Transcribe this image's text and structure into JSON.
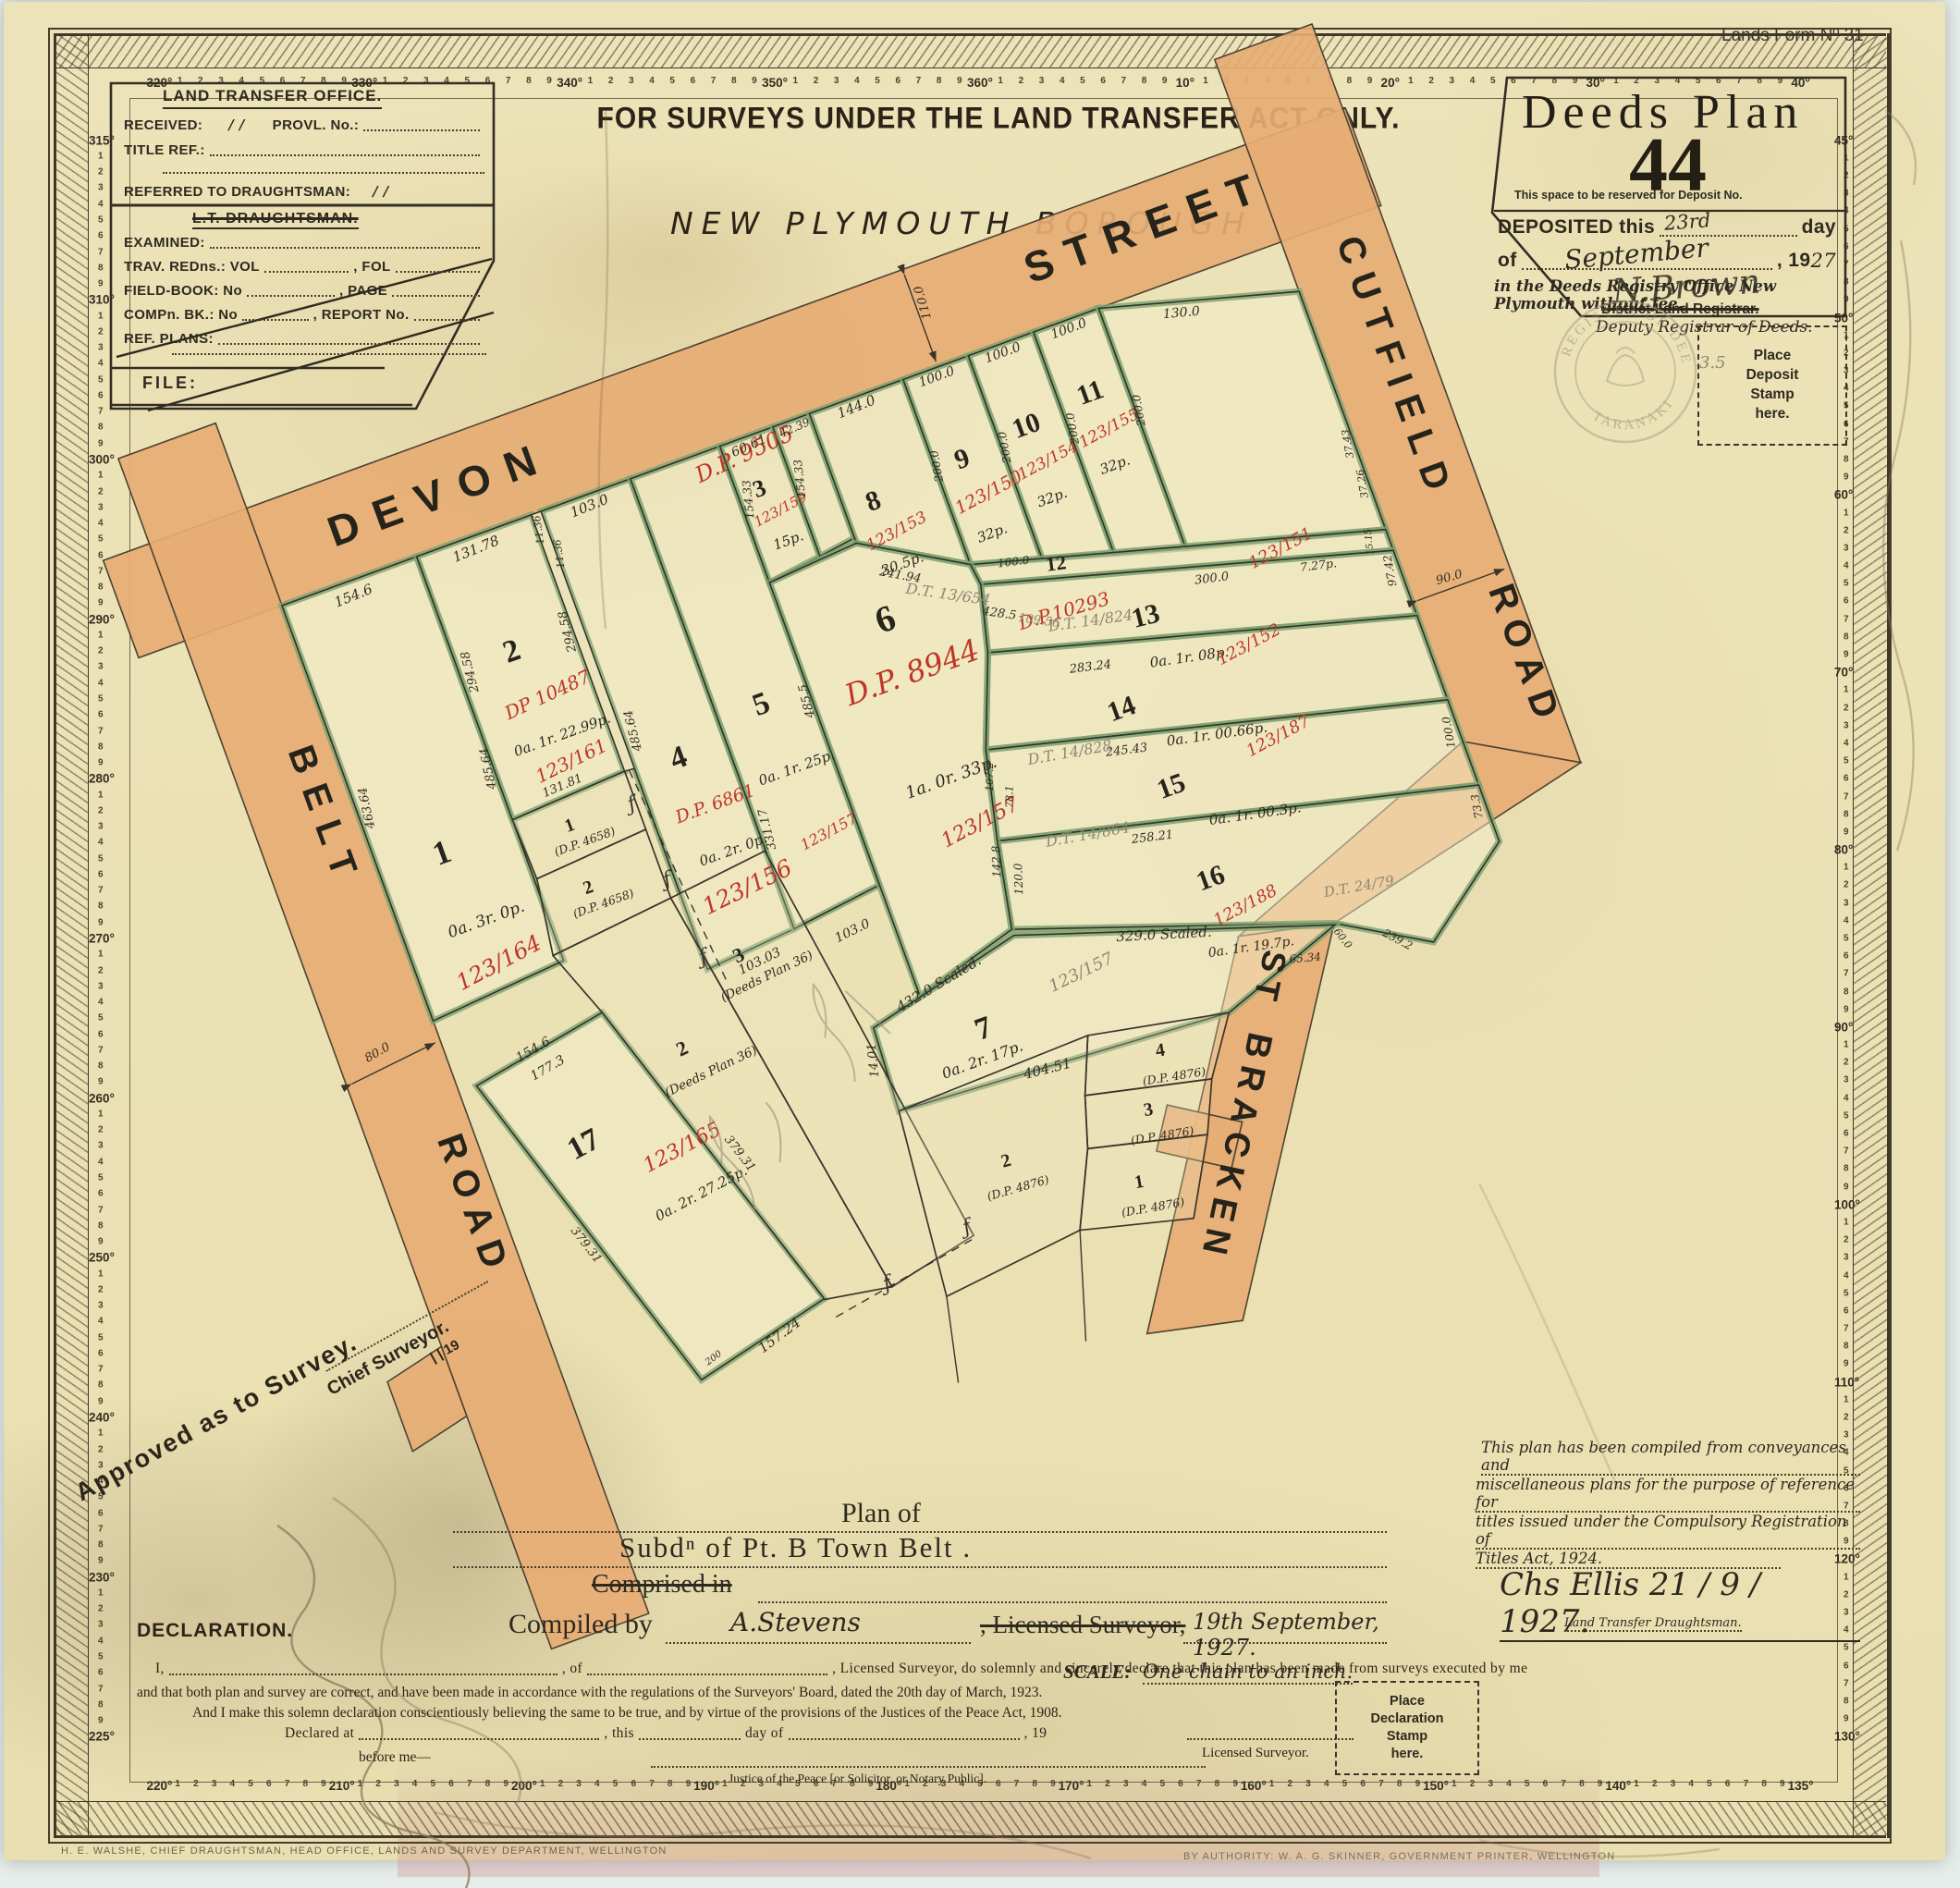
{
  "form_no": "Lands Form Nº 31",
  "header": {
    "restriction": "FOR SURVEYS UNDER THE LAND TRANSFER ACT ONLY.",
    "borough": "NEW PLYMOUTH BOROUGH"
  },
  "lto_box": {
    "title": "LAND TRANSFER OFFICE.",
    "received": "RECEIVED:",
    "received_date": "/      /",
    "provl": "PROVL. No.:",
    "title_ref": "TITLE REF.:",
    "referred": "REFERRED TO DRAUGHTSMAN:",
    "referred_date": "/      /",
    "draughtsman": "L.T. DRAUGHTSMAN.",
    "examined": "EXAMINED:",
    "trav": "TRAV. REDns.: VOL",
    "fol": ", FOL",
    "fieldbook": "FIELD-BOOK: No",
    "page": ", PAGE",
    "comp": "COMPn. BK.: No",
    "report": ", REPORT No.",
    "ref_plans": "REF. PLANS:",
    "file": "FILE:"
  },
  "deeds_box": {
    "title": "Deeds Plan",
    "number": "44",
    "reserve_note": "This space to be reserved for Deposit No.",
    "deposited": "DEPOSITED this",
    "deposited_day": "23rd",
    "day_word": "day",
    "of_word": "of",
    "month": "September",
    "year_print": ", 19",
    "year_hand": "27",
    "office_line": "in the Deeds Registry Office New Plymouth without fee.",
    "signature": "N.Brown",
    "registrar_struck": "District Land Registrar.",
    "registrar": "Deputy Registrar of Deeds."
  },
  "seal": {
    "top": "REGISTER OF DEEDS",
    "side": "TARANAKI"
  },
  "stamp_boxes": {
    "deposit": [
      "Place",
      "Deposit",
      "Stamp",
      "here."
    ],
    "declaration": [
      "Place",
      "Declaration",
      "Stamp",
      "here."
    ]
  },
  "map": {
    "roads": {
      "devon": "DEVON",
      "devon2": "STREET",
      "cutfield": "CUTFIELD",
      "cutfield2": "ROAD",
      "belt": "BELT",
      "belt2": "ROAD",
      "bracken": "BRACKEN",
      "bracken2": "ST"
    },
    "dp9505": "D.P. 9505",
    "lots": [
      {
        "num": "1",
        "ref": "123/164",
        "area": "0a. 3r. 0p."
      },
      {
        "num": "2",
        "dp": "DP 10487",
        "ref": "123/161",
        "area": "0a. 1r. 22.99p."
      },
      {
        "num": "3",
        "ref": "123/159",
        "area": "15p."
      },
      {
        "num": "4",
        "dp": "D.P. 6861",
        "ref": "123/156",
        "area": "0a. 2r. 0p."
      },
      {
        "num": "5",
        "ref": "123/157",
        "area": "0a. 1r. 25p."
      },
      {
        "num": "6",
        "dp": "D.P. 8944",
        "ref": "123/157",
        "area": "1a.  0r.  33p."
      },
      {
        "num": "7",
        "ref": "123/157",
        "area": "0a. 2r. 17p."
      },
      {
        "num": "8",
        "ref": "123/153",
        "area": "30.5p."
      },
      {
        "num": "9",
        "ref": "123/150",
        "area": "32p."
      },
      {
        "num": "10",
        "ref": "123/154",
        "area": "32p."
      },
      {
        "num": "11",
        "ref": "123/155",
        "area": "32p."
      },
      {
        "num": "12",
        "dp": "D.P.10293"
      },
      {
        "num": "13",
        "ref": "123/151",
        "area": "0a.  1r.  08p."
      },
      {
        "num": "14",
        "ref": "123/152",
        "area": "0a.  1r.  00.66p."
      },
      {
        "num": "15",
        "ref": "123/187",
        "area": "0a.  1r.  00.3p."
      },
      {
        "num": "16",
        "ref": "123/188",
        "area": "0a. 1r. 19.7p."
      },
      {
        "num": "17",
        "ref": "123/165",
        "area": "0a. 2r. 27.25p."
      },
      {
        "num": "1",
        "dp": "(D.P. 4658)"
      },
      {
        "num": "2",
        "dp": "(D.P. 4658)"
      },
      {
        "num": "2",
        "dp": "(Deeds Plan 36)"
      },
      {
        "num": "3",
        "dp": "(Deeds Plan 36)"
      },
      {
        "num": "1",
        "dp": "(D.P. 4876)"
      },
      {
        "num": "2",
        "dp": "(D.P. 4876)"
      },
      {
        "num": "3",
        "dp": "(D.P. 4876)"
      },
      {
        "num": "4",
        "dp": "(D.P. 4876)"
      }
    ],
    "dims": [
      {
        "t": "154.6"
      },
      {
        "t": "131.78"
      },
      {
        "t": "11.36"
      },
      {
        "t": "11.36"
      },
      {
        "t": "103.0"
      },
      {
        "t": "60.61"
      },
      {
        "t": "42.39"
      },
      {
        "t": "144.0"
      },
      {
        "t": "100.0"
      },
      {
        "t": "100.0"
      },
      {
        "t": "100.0"
      },
      {
        "t": "130.0"
      },
      {
        "t": "463.64"
      },
      {
        "t": "485.64"
      },
      {
        "t": "294.58"
      },
      {
        "t": "294.58"
      },
      {
        "t": "131.81"
      },
      {
        "t": "485.64"
      },
      {
        "t": "485.5"
      },
      {
        "t": "331.17"
      },
      {
        "t": "154.33"
      },
      {
        "t": "154.33"
      },
      {
        "t": "200.0"
      },
      {
        "t": "200.0"
      },
      {
        "t": "200.0"
      },
      {
        "t": "200.0"
      },
      {
        "t": "241.94"
      },
      {
        "t": "428.5"
      },
      {
        "t": "100.0"
      },
      {
        "t": "300.0"
      },
      {
        "t": "7.27p."
      },
      {
        "t": "15.15"
      },
      {
        "t": "37.43"
      },
      {
        "t": "37.26"
      },
      {
        "t": "283.24"
      },
      {
        "t": "97.42"
      },
      {
        "t": "245.43"
      },
      {
        "t": "100.0"
      },
      {
        "t": "258.21"
      },
      {
        "t": "73.3"
      },
      {
        "t": "142.8"
      },
      {
        "t": "120.0"
      },
      {
        "t": "239.2"
      },
      {
        "t": "65.34"
      },
      {
        "t": "60.0"
      },
      {
        "t": "329.0 Scaled."
      },
      {
        "t": "432.0 Scaled."
      },
      {
        "t": "404.51"
      },
      {
        "t": "103.03"
      },
      {
        "t": "103.0"
      },
      {
        "t": "14.01"
      },
      {
        "t": "154.6"
      },
      {
        "t": "177.3"
      },
      {
        "t": "379.31"
      },
      {
        "t": "379.31"
      },
      {
        "t": "157.24"
      },
      {
        "t": "200"
      },
      {
        "t": "80.0"
      },
      {
        "t": "110.0"
      },
      {
        "t": "90.0"
      },
      {
        "t": "107.2"
      },
      {
        "t": "78.1"
      }
    ],
    "pencil": [
      {
        "t": "D.T. 13/654"
      },
      {
        "t": "D.T. 14/824"
      },
      {
        "t": "D.T. 14/828"
      },
      {
        "t": "D.T. 14/864"
      },
      {
        "t": "D.T. 24/79"
      },
      {
        "t": "109.56"
      },
      {
        "t": "3.5"
      }
    ]
  },
  "approval": {
    "line1": "Approved as to Survey.",
    "line2": "Chief Surveyor.",
    "date": "|      | 19"
  },
  "title_block": {
    "plan_of": "Plan of",
    "subdivision": "Subdⁿ of  Pt. B  Town  Belt .",
    "comprised": "Comprised in",
    "compiled_by": "Compiled by",
    "surveyor": "A.Stevens",
    "licensed": ", Licensed Surveyor,",
    "date": "19th September, 1927."
  },
  "scale": {
    "label": "SCALE:",
    "value": "One  chain  to an inch."
  },
  "declaration": {
    "heading": "DECLARATION.",
    "i_word": "I,",
    "of_word": ", of",
    "line1_tail": ", Licensed Surveyor, do solemnly and sincerely declare that this plan has been made from surveys executed by me",
    "line2": "and that both plan and survey are correct, and have been made in accordance with the regulations of the Surveyors' Board, dated the 20th day of  March, 1923.",
    "line3": "And I make this solemn declaration conscientiously believing the same to be true, and by virtue of the provisions of the Justices of the Peace Act, 1908.",
    "declared_at": "Declared at",
    "this_word": ", this",
    "day_of": "day of",
    "year": ", 19",
    "before_me": "before me—",
    "jp": "Justice of the Peace [or Solicitor, or Notary Public].",
    "licensed_surveyor": "Licensed Surveyor."
  },
  "note": {
    "line1": "This plan has been compiled from conveyances and",
    "line2": "miscellaneous plans for the purpose of reference for",
    "line3": "titles issued under the Compulsory Registration of",
    "line4": "Titles Act, 1924.",
    "signature": "Chs Ellis  21 / 9 / 1927.",
    "role": "Land Transfer Draughtsman."
  },
  "footer": {
    "left": "H. E. WALSHE, CHIEF DRAUGHTSMAN, HEAD OFFICE, LANDS AND SURVEY DEPARTMENT, WELLINGTON",
    "right": "BY AUTHORITY: W. A. G. SKINNER, GOVERNMENT PRINTER, WELLINGTON"
  },
  "border": {
    "top": [
      "320°",
      "330°",
      "340°",
      "350°",
      "360°",
      "10°",
      "20°",
      "30°",
      "40°"
    ],
    "right": [
      "45°",
      "50°",
      "60°",
      "70°",
      "80°",
      "90°",
      "100°",
      "110°",
      "120°",
      "130°"
    ],
    "bottom": [
      "220°",
      "210°",
      "200°",
      "190°",
      "180°",
      "170°",
      "160°",
      "150°",
      "140°",
      "135°"
    ],
    "left": [
      "315°",
      "310°",
      "300°",
      "290°",
      "280°",
      "270°",
      "260°",
      "250°",
      "240°",
      "230°",
      "225°"
    ],
    "minors": [
      "1",
      "2",
      "3",
      "4",
      "5",
      "6",
      "7",
      "8",
      "9"
    ]
  }
}
